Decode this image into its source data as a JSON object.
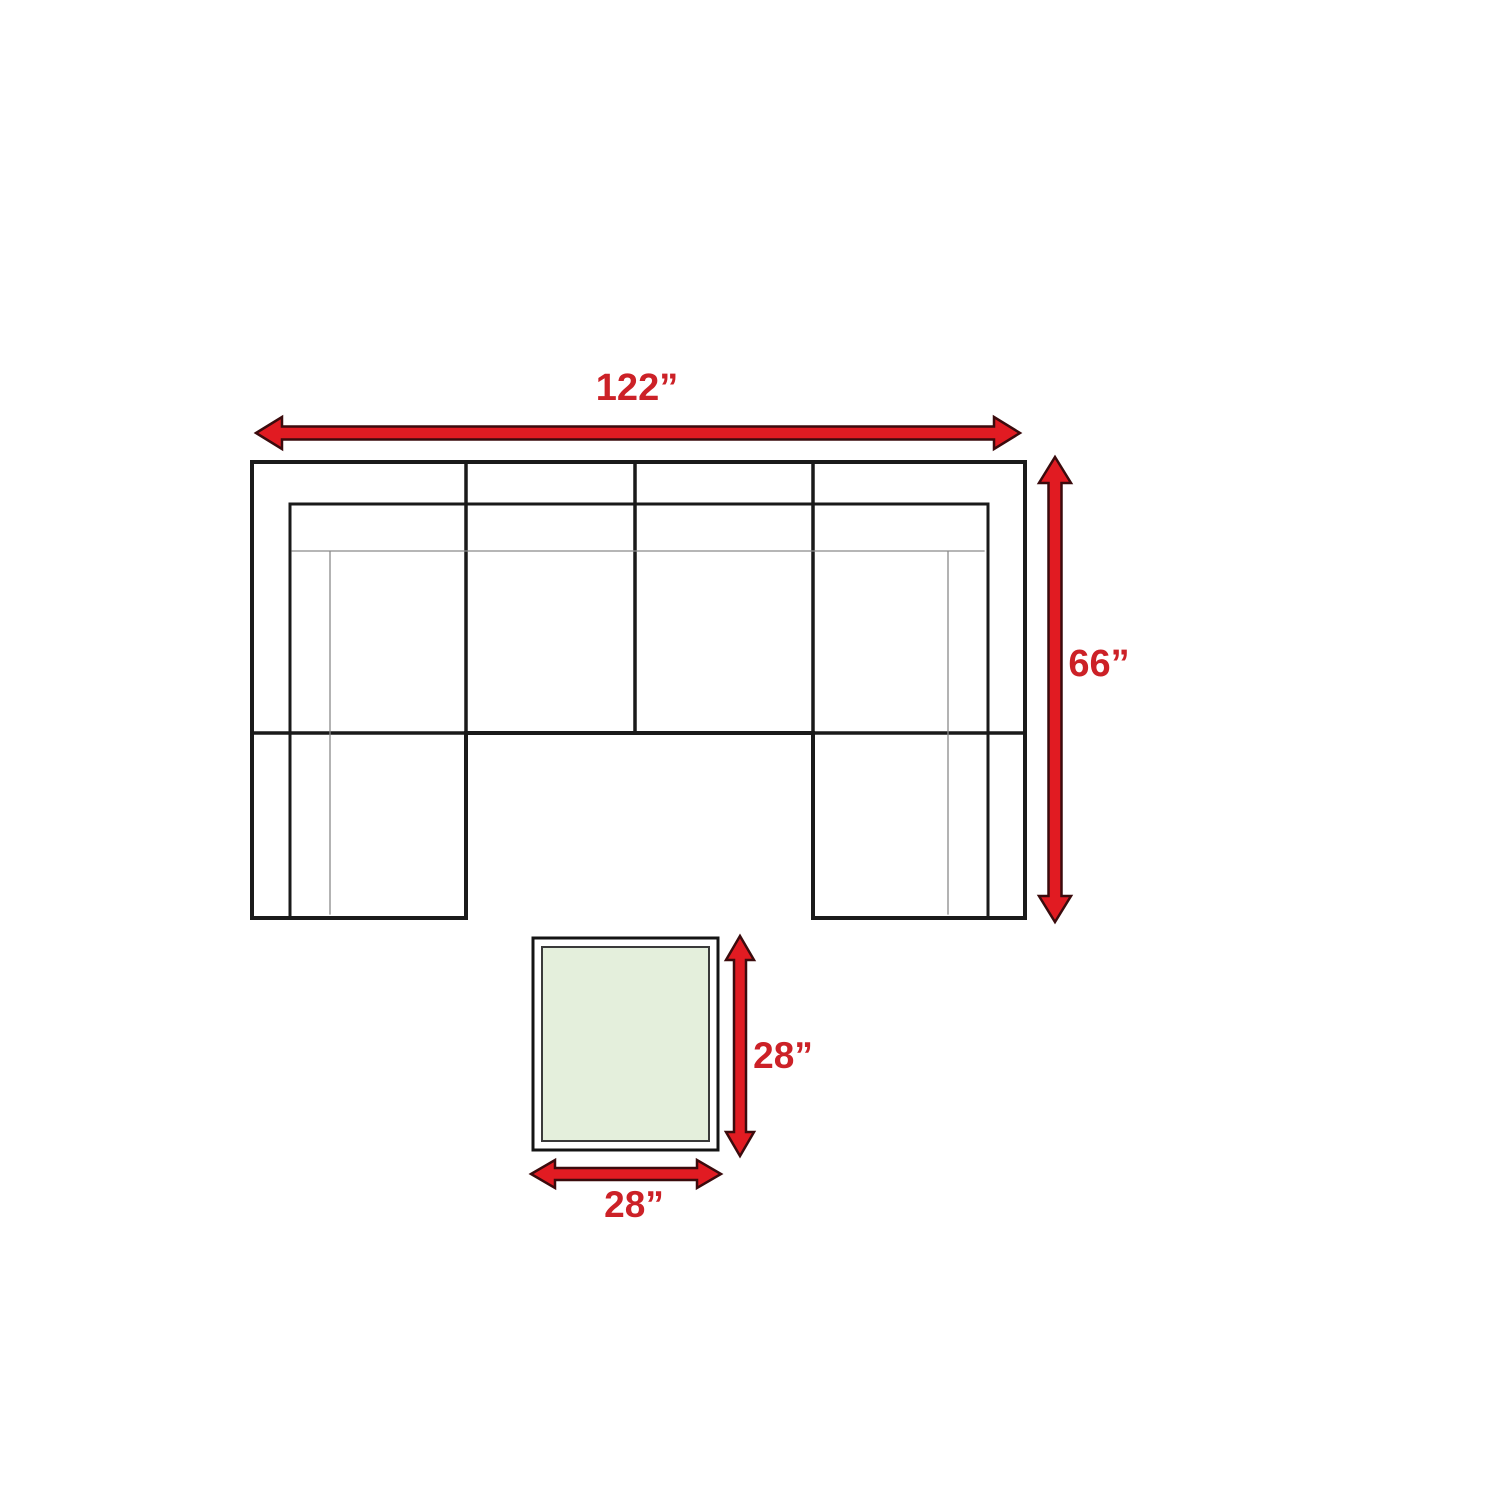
{
  "labels": {
    "sofa_width": "122”",
    "sofa_depth": "66”",
    "ottoman_height": "28”",
    "ottoman_width": "28”"
  },
  "colors": {
    "background": "#ffffff",
    "arrow_red": "#e11b22",
    "arrow_outline": "#3b0b0d",
    "label_red": "#cc2127",
    "sofa_line": "#1a1a1a",
    "seam_gray": "#8a8a8a",
    "ottoman_fill": "#e4efdc",
    "ottoman_border": "#141414",
    "ottoman_inner_border": "#3a3a3a"
  }
}
